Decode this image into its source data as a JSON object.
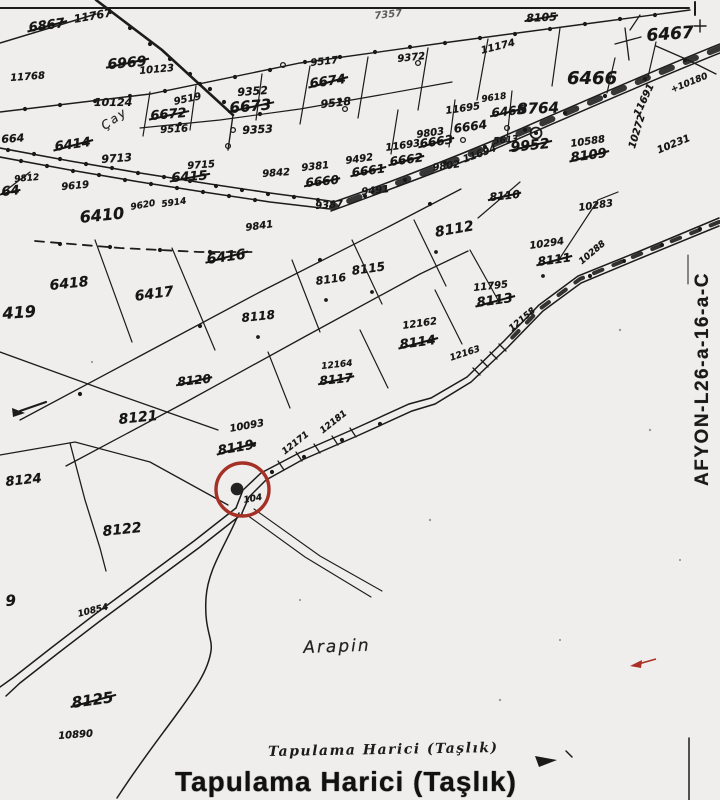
{
  "map": {
    "colors": {
      "ink": "#1c1c1c",
      "paper": "#efeeec",
      "highlight_red": "#a53126"
    },
    "sheet_code": "AFYON-L26-a-16-a-C",
    "notes": {
      "small": "Tapulama Harici (Taşlık)",
      "large": "Tapulama Harici (Taşlık)"
    },
    "labels": [
      {
        "t": "6867",
        "x": 28,
        "y": 22,
        "s": 13,
        "r": -8,
        "k": true
      },
      {
        "t": "11767",
        "x": 73,
        "y": 14,
        "s": 11,
        "r": -10
      },
      {
        "t": "6969",
        "x": 107,
        "y": 58,
        "s": 14,
        "r": -5,
        "k": true
      },
      {
        "t": "10123",
        "x": 139,
        "y": 67,
        "s": 10,
        "r": -5
      },
      {
        "t": "11768",
        "x": 10,
        "y": 74,
        "s": 10,
        "r": -4
      },
      {
        "t": "10124",
        "x": 94,
        "y": 97,
        "s": 11,
        "r": 0
      },
      {
        "t": "9519",
        "x": 173,
        "y": 98,
        "s": 10,
        "r": -12
      },
      {
        "t": "6672",
        "x": 150,
        "y": 110,
        "s": 13,
        "r": -5,
        "k": true
      },
      {
        "t": "9516",
        "x": 160,
        "y": 126,
        "s": 10,
        "r": -3
      },
      {
        "t": "9352",
        "x": 237,
        "y": 87,
        "s": 11,
        "r": -4
      },
      {
        "t": "6673",
        "x": 229,
        "y": 101,
        "s": 15,
        "r": -5,
        "k": true
      },
      {
        "t": "9353",
        "x": 242,
        "y": 125,
        "s": 11,
        "r": -3
      },
      {
        "t": "9517",
        "x": 310,
        "y": 59,
        "s": 10,
        "r": -6
      },
      {
        "t": "6674",
        "x": 309,
        "y": 78,
        "s": 13,
        "r": -8,
        "k": true
      },
      {
        "t": "9518",
        "x": 320,
        "y": 99,
        "s": 11,
        "r": -6
      },
      {
        "t": "7357",
        "x": 374,
        "y": 12,
        "s": 10,
        "r": -6,
        "c": "faint"
      },
      {
        "t": "9372",
        "x": 397,
        "y": 55,
        "s": 10,
        "r": -6
      },
      {
        "t": "11174",
        "x": 480,
        "y": 47,
        "s": 10,
        "r": -14
      },
      {
        "t": "8105",
        "x": 526,
        "y": 13,
        "s": 11,
        "r": -3,
        "k": true
      },
      {
        "t": "6466",
        "x": 567,
        "y": 70,
        "s": 18,
        "r": 0
      },
      {
        "t": "6467",
        "x": 646,
        "y": 28,
        "s": 17,
        "r": -4
      },
      {
        "t": "664",
        "x": 1,
        "y": 134,
        "s": 11,
        "r": -4
      },
      {
        "t": "6414",
        "x": 54,
        "y": 141,
        "s": 13,
        "r": -8,
        "k": true
      },
      {
        "t": "9713",
        "x": 101,
        "y": 154,
        "s": 11,
        "r": -4
      },
      {
        "t": "Çay",
        "x": 99,
        "y": 122,
        "s": 12,
        "r": -35,
        "c": "place"
      },
      {
        "t": "9812",
        "x": 14,
        "y": 176,
        "s": 9,
        "r": -5
      },
      {
        "t": "64",
        "x": 1,
        "y": 186,
        "s": 13,
        "r": -6,
        "k": true
      },
      {
        "t": "9619",
        "x": 61,
        "y": 183,
        "s": 10,
        "r": -5
      },
      {
        "t": "9715",
        "x": 187,
        "y": 162,
        "s": 10,
        "r": -4
      },
      {
        "t": "6415",
        "x": 171,
        "y": 172,
        "s": 13,
        "r": -4,
        "k": true
      },
      {
        "t": "9842",
        "x": 262,
        "y": 170,
        "s": 10,
        "r": -4
      },
      {
        "t": "9381",
        "x": 301,
        "y": 164,
        "s": 10,
        "r": -6
      },
      {
        "t": "6660",
        "x": 305,
        "y": 177,
        "s": 12,
        "r": -6,
        "k": true
      },
      {
        "t": "9492",
        "x": 345,
        "y": 157,
        "s": 10,
        "r": -8
      },
      {
        "t": "6661",
        "x": 351,
        "y": 167,
        "s": 12,
        "r": -8,
        "k": true
      },
      {
        "t": "11693",
        "x": 385,
        "y": 144,
        "s": 10,
        "r": -8
      },
      {
        "t": "6662",
        "x": 389,
        "y": 156,
        "s": 12,
        "r": -8,
        "k": true
      },
      {
        "t": "9803",
        "x": 416,
        "y": 131,
        "s": 10,
        "r": -8
      },
      {
        "t": "6663",
        "x": 419,
        "y": 138,
        "s": 12,
        "r": -8,
        "k": true
      },
      {
        "t": "6664",
        "x": 453,
        "y": 123,
        "s": 12,
        "r": -8
      },
      {
        "t": "11695",
        "x": 445,
        "y": 107,
        "s": 10,
        "r": -8
      },
      {
        "t": "9618",
        "x": 481,
        "y": 96,
        "s": 9,
        "r": -8
      },
      {
        "t": "5613",
        "x": 493,
        "y": 138,
        "s": 9,
        "r": -6
      },
      {
        "t": "6465",
        "x": 491,
        "y": 107,
        "s": 12,
        "r": -6,
        "k": true
      },
      {
        "t": "8764",
        "x": 517,
        "y": 102,
        "s": 15,
        "r": -2
      },
      {
        "t": "9952",
        "x": 510,
        "y": 141,
        "s": 14,
        "r": -6,
        "k": true
      },
      {
        "t": "10588",
        "x": 570,
        "y": 140,
        "s": 10,
        "r": -8
      },
      {
        "t": "8109",
        "x": 570,
        "y": 152,
        "s": 13,
        "r": -8,
        "k": true
      },
      {
        "t": "11691",
        "x": 633,
        "y": 114,
        "s": 10,
        "r": -65
      },
      {
        "t": "10272",
        "x": 628,
        "y": 147,
        "s": 10,
        "r": -73
      },
      {
        "t": "10231",
        "x": 656,
        "y": 147,
        "s": 10,
        "r": -22
      },
      {
        "t": "+10180",
        "x": 670,
        "y": 87,
        "s": 9,
        "r": -22
      },
      {
        "t": "9491",
        "x": 361,
        "y": 188,
        "s": 10,
        "r": -6
      },
      {
        "t": "9802",
        "x": 432,
        "y": 164,
        "s": 10,
        "r": -8
      },
      {
        "t": "11694",
        "x": 462,
        "y": 156,
        "s": 10,
        "r": -20
      },
      {
        "t": "9387",
        "x": 315,
        "y": 202,
        "s": 10,
        "r": -4
      },
      {
        "t": "8110",
        "x": 489,
        "y": 192,
        "s": 11,
        "r": -6,
        "k": true
      },
      {
        "t": "10283",
        "x": 578,
        "y": 204,
        "s": 10,
        "r": -8
      },
      {
        "t": "6410",
        "x": 79,
        "y": 210,
        "s": 16,
        "r": -6
      },
      {
        "t": "9620",
        "x": 130,
        "y": 204,
        "s": 9,
        "r": -10
      },
      {
        "t": "5914",
        "x": 161,
        "y": 201,
        "s": 9,
        "r": -8
      },
      {
        "t": "9841",
        "x": 245,
        "y": 224,
        "s": 10,
        "r": -8
      },
      {
        "t": "6416",
        "x": 206,
        "y": 253,
        "s": 14,
        "r": -8,
        "k": true
      },
      {
        "t": "6418",
        "x": 49,
        "y": 279,
        "s": 14,
        "r": -6
      },
      {
        "t": "6417",
        "x": 134,
        "y": 290,
        "s": 14,
        "r": -8
      },
      {
        "t": "419",
        "x": 2,
        "y": 306,
        "s": 16,
        "r": -4
      },
      {
        "t": "8116",
        "x": 315,
        "y": 276,
        "s": 11,
        "r": -8
      },
      {
        "t": "8115",
        "x": 351,
        "y": 265,
        "s": 12,
        "r": -8
      },
      {
        "t": "8112",
        "x": 434,
        "y": 226,
        "s": 14,
        "r": -10
      },
      {
        "t": "10294",
        "x": 529,
        "y": 242,
        "s": 10,
        "r": -8
      },
      {
        "t": "8111",
        "x": 537,
        "y": 256,
        "s": 12,
        "r": -8,
        "k": true
      },
      {
        "t": "11795",
        "x": 473,
        "y": 284,
        "s": 10,
        "r": -6
      },
      {
        "t": "8113",
        "x": 476,
        "y": 297,
        "s": 13,
        "r": -8,
        "k": true
      },
      {
        "t": "12162",
        "x": 402,
        "y": 322,
        "s": 10,
        "r": -8
      },
      {
        "t": "8114",
        "x": 399,
        "y": 339,
        "s": 13,
        "r": -8,
        "k": true
      },
      {
        "t": "12163",
        "x": 449,
        "y": 355,
        "s": 9,
        "r": -18
      },
      {
        "t": "12158",
        "x": 508,
        "y": 327,
        "s": 9,
        "r": -40
      },
      {
        "t": "10288",
        "x": 578,
        "y": 260,
        "s": 9,
        "r": -40
      },
      {
        "t": "8118",
        "x": 241,
        "y": 312,
        "s": 12,
        "r": -6
      },
      {
        "t": "8120",
        "x": 177,
        "y": 376,
        "s": 12,
        "r": -6,
        "k": true
      },
      {
        "t": "12164",
        "x": 321,
        "y": 363,
        "s": 9,
        "r": -6
      },
      {
        "t": "8117",
        "x": 319,
        "y": 375,
        "s": 12,
        "r": -6,
        "k": true
      },
      {
        "t": "8121",
        "x": 118,
        "y": 413,
        "s": 14,
        "r": -6
      },
      {
        "t": "10093",
        "x": 229,
        "y": 425,
        "s": 10,
        "r": -10
      },
      {
        "t": "8119",
        "x": 217,
        "y": 445,
        "s": 13,
        "r": -10,
        "k": true
      },
      {
        "t": "12181",
        "x": 319,
        "y": 429,
        "s": 9,
        "r": -38
      },
      {
        "t": "12171",
        "x": 281,
        "y": 450,
        "s": 9,
        "r": -38
      },
      {
        "t": "104",
        "x": 243,
        "y": 497,
        "s": 9,
        "r": -10
      },
      {
        "t": "8124",
        "x": 5,
        "y": 476,
        "s": 13,
        "r": -6
      },
      {
        "t": "8122",
        "x": 102,
        "y": 525,
        "s": 14,
        "r": -6
      },
      {
        "t": "10854",
        "x": 77,
        "y": 611,
        "s": 9,
        "r": -14
      },
      {
        "t": "9",
        "x": 5,
        "y": 594,
        "s": 15,
        "r": -4
      },
      {
        "t": "8125",
        "x": 71,
        "y": 696,
        "s": 15,
        "r": -8,
        "k": true
      },
      {
        "t": "10890",
        "x": 58,
        "y": 732,
        "s": 10,
        "r": -4
      },
      {
        "t": "Arapin",
        "x": 303,
        "y": 640,
        "s": 17,
        "r": -2,
        "c": "place"
      }
    ]
  }
}
